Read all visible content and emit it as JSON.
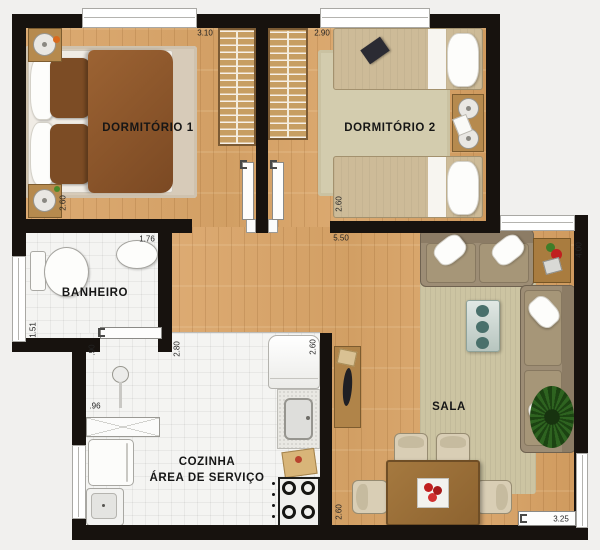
{
  "rooms": {
    "dorm1": {
      "name": "DORMITÓRIO 1",
      "width": "3.10",
      "depth": "2.60"
    },
    "dorm2": {
      "name": "DORMITÓRIO 2",
      "width": "2.90",
      "depth": "2.60"
    },
    "bathroom": {
      "name": "BANHEIRO",
      "width": "1.76",
      "depth": "1.51"
    },
    "shower": {
      "width": ".90",
      "depth": ".96"
    },
    "kitchen": {
      "name": "COZINHA",
      "name2": "ÁREA DE SERVIÇO",
      "depth_left": "2.80",
      "depth_right": "2.60"
    },
    "living": {
      "name": "SALA",
      "width": "5.50",
      "depth": "4.00",
      "dining_depth": "2.60",
      "slider_width": "3.25"
    }
  },
  "palette": {
    "wall": "#17120e",
    "wood_floor": "#d9a76e",
    "tile_floor": "#f4f4f2",
    "bed_brown": "#8a5528",
    "sofa_taupe": "#9d8d75",
    "accent_red": "#c01f1f",
    "plant_green": "#2e6320"
  }
}
